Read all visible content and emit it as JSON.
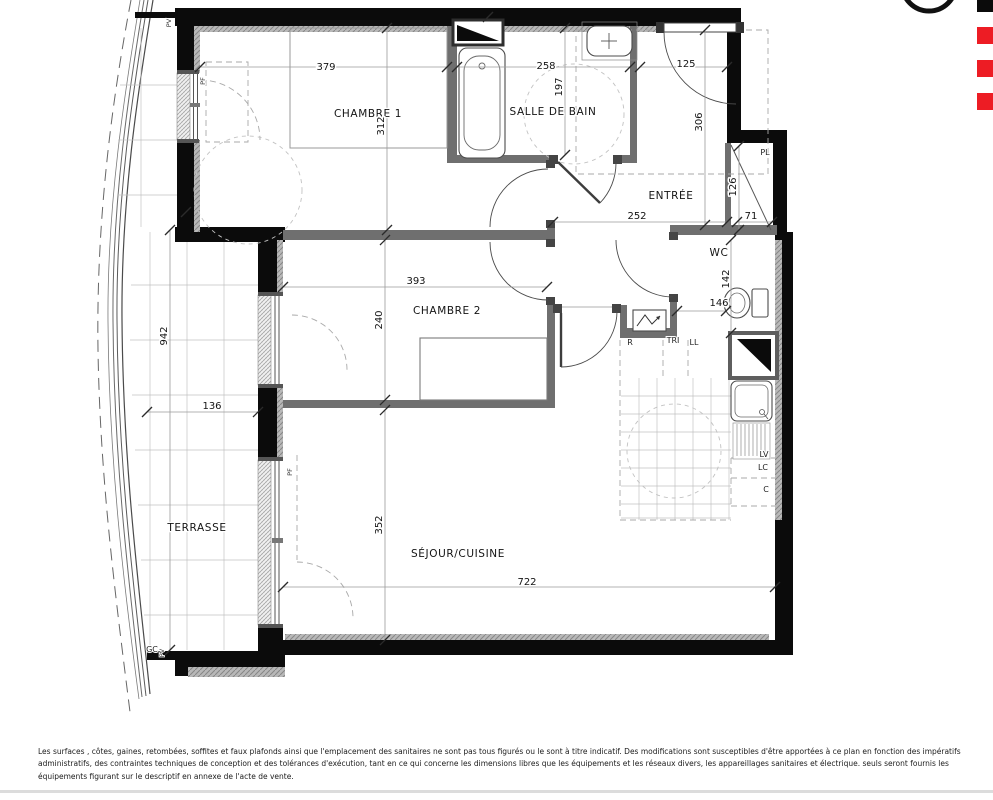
{
  "plan": {
    "rooms": {
      "chambre1": {
        "name": "CHAMBRE 1",
        "width": "379",
        "depth": "312"
      },
      "salle_de_bain": {
        "name": "SALLE DE BAIN",
        "width": "258",
        "depth": "197"
      },
      "entree": {
        "name": "ENTRÉE",
        "width": "125",
        "depth": "306",
        "hall_width": "252"
      },
      "placard": {
        "name": "PL",
        "width": "71",
        "depth": "126"
      },
      "wc": {
        "name": "WC",
        "width": "146",
        "depth": "142"
      },
      "chambre2": {
        "name": "CHAMBRE 2",
        "width": "393",
        "depth": "240"
      },
      "terrasse": {
        "name": "TERRASSE",
        "width": "136",
        "depth": "942"
      },
      "sejour_cuisine": {
        "name": "SÉJOUR/CUISINE",
        "width": "722",
        "depth": "352"
      }
    },
    "equipment": {
      "r": "R",
      "tri": "TRI",
      "ll": "LL",
      "lv": "LV",
      "lc": "LC",
      "c": "C",
      "gc": "GC",
      "pv": "PV",
      "pf": "PF"
    }
  },
  "footer": {
    "line1": "Les surfaces , côtes, gaines, retombées, soffites et faux plafonds ainsi que l'emplacement des sanitaires ne sont pas tous figurés ou le sont à titre indicatif. Des modifications sont susceptibles d'être apportées à ce plan en fonction des impératifs",
    "line2": "administratifs, des contraintes techniques de conception et des tolérances d'exécution, tant en ce qui concerne les dimensions libres que les équipements et les réseaux divers, les appareillages sanitaires et électrique. seuls seront fournis les",
    "line3": "équipements figurant sur le descriptif en annexe de l'acte de vente."
  },
  "colors": {
    "accent_red": "#ed1c24",
    "wall": "#0b0b0b"
  }
}
